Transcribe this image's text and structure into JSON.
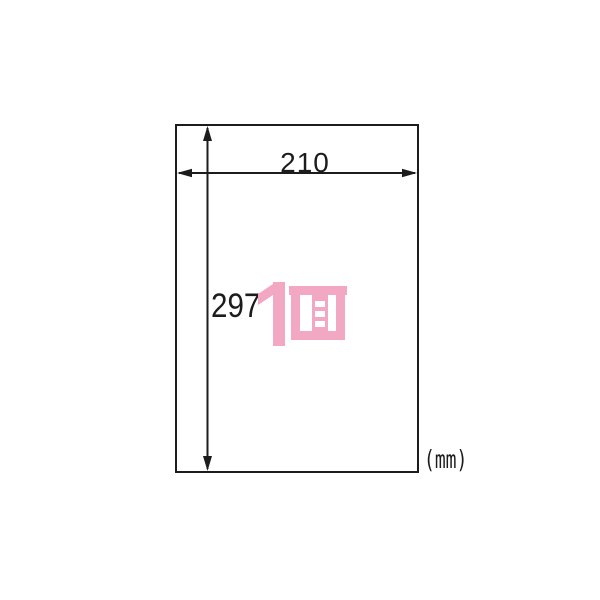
{
  "diagram": {
    "width_mm": "210",
    "height_mm": "297",
    "unit": "(mm)",
    "face_label": "1面",
    "colors": {
      "pink": "#F2A8C2",
      "line": "#1C1C1C",
      "paper": "#FFFFFF"
    }
  }
}
